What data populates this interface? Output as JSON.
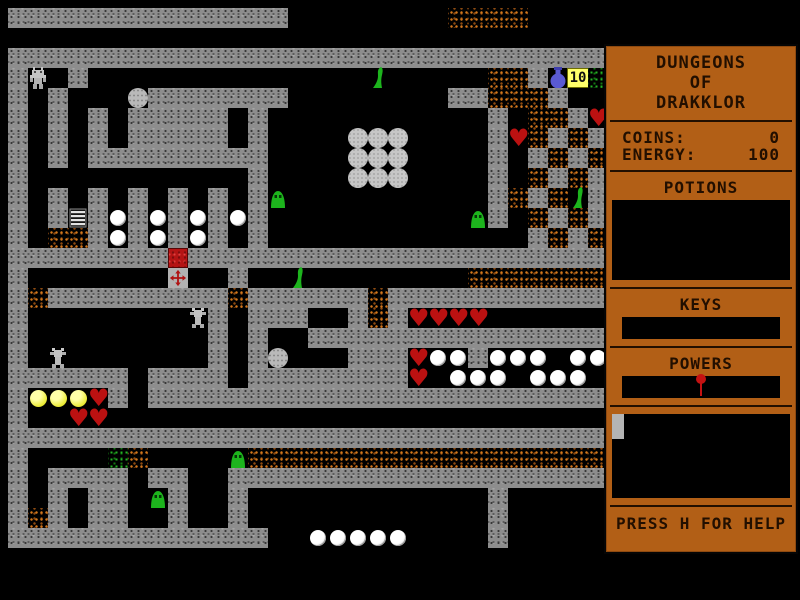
{
  "window": {
    "width": 800,
    "height": 600,
    "background": "#000000"
  },
  "sidebar": {
    "title_lines": [
      "DUNGEONS",
      "OF",
      "DRAKKLOR"
    ],
    "stats": {
      "coins_label": "COINS:",
      "coins_value": "0",
      "energy_label": "ENERGY:",
      "energy_value": "100"
    },
    "sections": {
      "potions_label": "POTIONS",
      "keys_label": "KEYS",
      "powers_label": "POWERS"
    },
    "powers_slot_icon": "red-pin",
    "inventory_marker": "gray-tab",
    "help_text": "PRESS H FOR HELP",
    "colors": {
      "panel": "#b25f16",
      "panel_text": "#220f00",
      "slot_bg": "#000000"
    }
  },
  "map": {
    "tile_size": 20,
    "cols": 30,
    "rows_count": 30,
    "coin_counter": "10",
    "legend": {
      "#": "wall",
      ".": "floor",
      "d": "rubble",
      "g": "moss",
      "P": "pearl",
      "W": "stone-ball",
      "B": "boulder",
      "H": "heart",
      "Y": "gold-orb",
      "S": "slime",
      "G": "slime-eyed",
      "C": "red-chest",
      "X": "cross-marker",
      "L": "ladder",
      "J": "blue-flask",
      "T": "coin-counter",
      "R": "player-robot",
      "M": "mech"
    },
    "rows": [
      "##############........dddd....",
      "..............................",
      "##############################",
      "#R.#..............S.....dd#JTg",
      "#.#...B#######........##ddd#..",
      "#.#.#.#####.#...........#.dd#H",
      "#.#.#.#####.#....WWW....#Hd#d#",
      "#.#.#########....WWW....#.#d#d",
      "#...........#....WWW....#.d#d#",
      "#.#.#.#.#.#.#G..........#d#dS#",
      "#.#L#P#P#P#P#..........G#.d#d#",
      "#.dd#P#P#P#.#.............#d#d",
      "########C#####################",
      "#.......X..#..S........ddddddd",
      "#d#########d######d###########",
      "#........M#.###..#d#HHHH......",
      "#.........#.#..###############",
      "#.M.......#.#B...###HPP#PPP.PP",
      "######.####.########H.PPP.PPP.",
      "#YYYH#.#######################",
      "#..HH.........................",
      "##############################",
      "#....gd....Gdddddddddddddddddd",
      "#.####.##..###################",
      "#.#.##.G#..#............#.....",
      "#d#.##..#..#............#.....",
      "#############..PPPPP....#.....",
      "..............................",
      "..............................",
      ".............................."
    ],
    "colors": {
      "wall": "#8d8d8d",
      "rubble": "#cc6418",
      "moss": "#1ea41e",
      "heart": "#bb1111",
      "slime": "#1db41d",
      "pearl": "#ffffff",
      "gold": "#ecec38",
      "flask": "#5a5ad2",
      "counter_bg": "#ffff6a",
      "chest": "#b41414",
      "cross": "#b01212"
    }
  }
}
